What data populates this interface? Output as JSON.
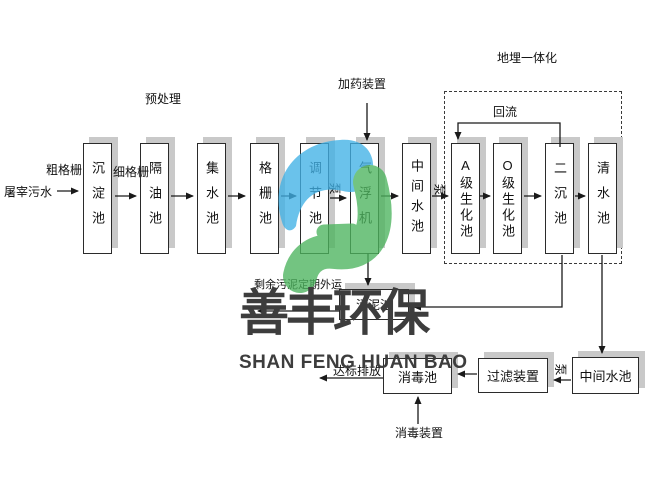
{
  "flow_labels": {
    "influent": "屠宰污水",
    "coarse_screen": "粗格栅",
    "fine_screen": "细格栅",
    "pretreatment": "预处理",
    "dosing_device": "加药装置",
    "buried_integration": "地埋一体化",
    "reflux": "回流",
    "pump_a": "泵",
    "pump_b": "泵",
    "pump_c": "泵",
    "excess_sludge": "剩余污泥定期外运",
    "discharge": "达标排放",
    "disinfection_device": "消毒装置"
  },
  "row1": [
    {
      "label": "沉淀池"
    },
    {
      "label": "隔油池"
    },
    {
      "label": "集水池"
    },
    {
      "label": "格栅池"
    },
    {
      "label": "调节池"
    },
    {
      "label": "气浮机"
    },
    {
      "label": "中间水池"
    },
    {
      "label": "A级生化池"
    },
    {
      "label": "O级生化池"
    },
    {
      "label": "二沉池"
    },
    {
      "label": "清水池"
    }
  ],
  "bottom": {
    "sludge_tank": "污泥池",
    "disinfection_tank": "消毒池",
    "filter_device": "过滤装置",
    "intermediate_tank": "中间水池"
  },
  "watermark": {
    "cn": "善丰环保",
    "en": "SHAN FENG HUAN BAO",
    "blue": "#41b1e6",
    "green": "#4db45e",
    "text_color": "#3d3d3d"
  }
}
